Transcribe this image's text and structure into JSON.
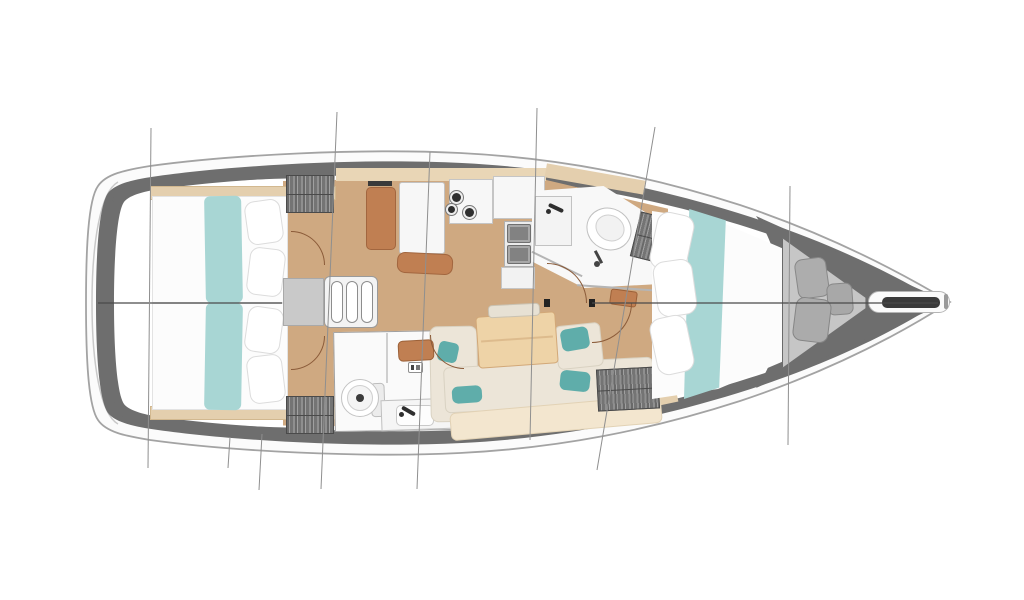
{
  "meta": {
    "drawing": "sailboat-interior-deck-plan",
    "canvas_width": 1024,
    "canvas_height": 600,
    "background": "#ffffff"
  },
  "palette": {
    "hull_fill": "#fbfbfb",
    "hull_stroke": "#a3a3a3",
    "deck_band": "#6e6e6e",
    "interior": "#ffffff",
    "floor_wood": "#cfa981",
    "wood_trim": "#e4cfae",
    "teal_fabric": "#a8d6d4",
    "teal_pillow": "#5fadaa",
    "sofa_cream": "#ece5d8",
    "sofa_back": "#f3e6cf",
    "furniture_brown": "#c07f52",
    "locker_gray": "#7c7c7c",
    "centerline": "#4a4a4a",
    "station_line": "#8f8f8f",
    "door_arc": "#8a5a38"
  },
  "hull": {
    "paths": [
      {
        "name": "hull-outer",
        "d": "M950,302 C900,272 830,235 740,205 C650,176 560,158 460,153 C360,148 230,155 150,166 C125,170 106,174 98,186 C88,200 86,250 86,303 C86,356 88,406 98,420 C106,432 125,436 150,440 C230,451 360,458 460,453 C560,448 650,430 740,401 C830,371 900,334 950,302 Z",
        "fill": "#fbfbfb",
        "stroke": "#a3a3a3",
        "sw": 1.8
      },
      {
        "name": "transom-inner-line",
        "d": "M118,182 C100,192 92,244 92,303 C92,362 100,414 118,424",
        "fill": "none",
        "stroke": "#c9c9c9",
        "sw": 1.5
      },
      {
        "name": "deck-band",
        "d": "M940,302 C895,275 828,241 738,213 C650,186 560,168 462,163 C364,158 236,165 158,176 C136,179 116,183 108,193 C99,206 96,252 96,303 C96,354 99,400 108,413 C116,423 136,427 158,430 C236,441 364,448 462,443 C560,438 650,420 738,393 C828,365 895,331 940,302 Z",
        "fill": "#6e6e6e",
        "stroke": "none",
        "sw": 0
      },
      {
        "name": "interior-fill",
        "d": "M922,302 C880,278 818,248 730,222 C646,197 558,180 462,176 C368,172 242,178 168,188 C150,190 130,194 124,202 C117,212 114,255 114,303 C114,351 117,394 124,404 C130,412 150,416 168,418 C242,428 368,434 462,430 C558,426 646,409 730,384 C818,358 880,328 922,302 Z",
        "fill": "#ffffff",
        "stroke": "none",
        "sw": 0
      },
      {
        "name": "stern-wedge-top",
        "d": "M112,200 C120,186 145,178 190,173 L330,166 L330,178 C260,178 190,182 150,190 C132,194 120,198 116,205 Z",
        "fill": "#6e6e6e",
        "stroke": "none",
        "sw": 0
      },
      {
        "name": "stern-wedge-bottom",
        "d": "M112,406 C120,420 145,428 190,433 L330,440 L330,428 C260,428 190,424 150,416 C132,412 120,408 116,401 Z",
        "fill": "#6e6e6e",
        "stroke": "none",
        "sw": 0
      },
      {
        "name": "bow-wedge",
        "d": "M756,216 L948,302 L756,388 C790,342 790,264 756,216 Z",
        "fill": "#6e6e6e",
        "stroke": "none",
        "sw": 0
      }
    ]
  },
  "furniture": [
    {
      "n": "salon-floor",
      "x": 283,
      "y": 176,
      "w": 385,
      "h": 252,
      "f": "#cfa981",
      "cls": "plank",
      "clip": "polygon(0 2%,64% 0,100% 13%,100% 79%,82% 97%,56% 100%,0 99%)"
    },
    {
      "n": "shelf-trim-aft-top",
      "x": 150,
      "y": 186,
      "w": 186,
      "h": 14,
      "f": "#e4cfae",
      "b": "#d2b88f"
    },
    {
      "n": "shelf-trim-aft-bottom",
      "x": 150,
      "y": 406,
      "w": 186,
      "h": 14,
      "f": "#e4cfae",
      "b": "#d2b88f"
    },
    {
      "n": "shelf-trim-galley-top",
      "x": 336,
      "y": 168,
      "w": 210,
      "h": 13,
      "f": "#e9d6b6"
    },
    {
      "n": "shelf-trim-fwd-top",
      "x": 545,
      "y": 172,
      "w": 100,
      "h": 14,
      "f": "#e4cfae",
      "rot": 10
    },
    {
      "n": "shelf-trim-fwd-bottom",
      "x": 578,
      "y": 398,
      "w": 100,
      "h": 14,
      "f": "#e4cfae",
      "rot": -12
    },
    {
      "n": "bed-aft-port",
      "x": 152,
      "y": 196,
      "w": 136,
      "h": 107,
      "f": "#fcfcfc",
      "b": "#e3e3e3"
    },
    {
      "n": "bed-runner-teal-port",
      "x": 205,
      "y": 196,
      "w": 37,
      "h": 107,
      "f": "#a8d6d4",
      "rad": "6px",
      "rot": -1
    },
    {
      "n": "pillow-aft-port-1",
      "x": 246,
      "y": 200,
      "w": 36,
      "h": 44,
      "f": "#ffffff",
      "b": "#dcdcdc",
      "rad": "10px",
      "rot": -8
    },
    {
      "n": "pillow-aft-port-2",
      "x": 248,
      "y": 248,
      "w": 36,
      "h": 48,
      "f": "#ffffff",
      "b": "#dcdcdc",
      "rad": "10px",
      "rot": 7
    },
    {
      "n": "bed-aft-starboard",
      "x": 152,
      "y": 303,
      "w": 136,
      "h": 107,
      "f": "#fcfcfc",
      "b": "#e3e3e3"
    },
    {
      "n": "bed-runner-teal-starboard",
      "x": 205,
      "y": 303,
      "w": 37,
      "h": 107,
      "f": "#a8d6d4",
      "rad": "6px",
      "rot": 1
    },
    {
      "n": "pillow-aft-starboard-1",
      "x": 246,
      "y": 307,
      "w": 36,
      "h": 46,
      "f": "#ffffff",
      "b": "#dcdcdc",
      "rad": "10px",
      "rot": 8
    },
    {
      "n": "pillow-aft-starboard-2",
      "x": 248,
      "y": 355,
      "w": 36,
      "h": 48,
      "f": "#ffffff",
      "b": "#dcdcdc",
      "rad": "10px",
      "rot": -7
    },
    {
      "n": "hanging-locker-aft-port",
      "x": 286,
      "y": 175,
      "w": 48,
      "h": 38,
      "cls": "hatch"
    },
    {
      "n": "hanging-locker-aft-starboard",
      "x": 286,
      "y": 396,
      "w": 48,
      "h": 38,
      "cls": "hatch"
    },
    {
      "n": "companionway-landing",
      "x": 283,
      "y": 278,
      "w": 41,
      "h": 48,
      "f": "#c9c9c9",
      "b": "#a9a9a9"
    },
    {
      "n": "companionway-steps-frame",
      "x": 324,
      "y": 276,
      "w": 54,
      "h": 52,
      "f": "#f3f3f3",
      "b": "#9a9a9a",
      "rad": "6px"
    },
    {
      "n": "companionway-step-1",
      "x": 331,
      "y": 281,
      "w": 12,
      "h": 42,
      "f": "#ffffff",
      "b": "#8d8d8d",
      "rad": "6px"
    },
    {
      "n": "companionway-step-2",
      "x": 346,
      "y": 281,
      "w": 12,
      "h": 42,
      "f": "#ffffff",
      "b": "#8d8d8d",
      "rad": "6px"
    },
    {
      "n": "companionway-step-3",
      "x": 361,
      "y": 281,
      "w": 12,
      "h": 42,
      "f": "#ffffff",
      "b": "#8d8d8d",
      "rad": "6px"
    },
    {
      "n": "nav-seat",
      "x": 366,
      "y": 187,
      "w": 30,
      "h": 63,
      "f": "#c07f52",
      "b": "#a2663f",
      "rad": "5px"
    },
    {
      "n": "nav-table",
      "x": 399,
      "y": 182,
      "w": 46,
      "h": 72,
      "f": "#f7f7f7",
      "b": "#c2c2c2",
      "rad": "3px"
    },
    {
      "n": "galley-vent-slot",
      "x": 368,
      "y": 181,
      "w": 24,
      "h": 5,
      "f": "#3a3a3a"
    },
    {
      "n": "nav-locker",
      "x": 397,
      "y": 253,
      "w": 56,
      "h": 21,
      "f": "#c07f52",
      "b": "#a2663f",
      "rad": "8px",
      "rot": 3
    },
    {
      "n": "galley-stove-counter",
      "x": 449,
      "y": 179,
      "w": 44,
      "h": 45,
      "f": "#f7f7f7",
      "b": "#c5c5c5"
    },
    {
      "n": "stove-burner-ring-1",
      "x": 449,
      "y": 190,
      "w": 15,
      "h": 15,
      "f": "#ededed",
      "b": "#777777",
      "rad": "50%"
    },
    {
      "n": "stove-burner-dot-1",
      "x": 452,
      "y": 193,
      "w": 9,
      "h": 9,
      "f": "#2f2f2f",
      "rad": "50%"
    },
    {
      "n": "stove-burner-ring-2",
      "x": 445,
      "y": 203,
      "w": 13,
      "h": 13,
      "f": "#ededed",
      "b": "#777777",
      "rad": "50%"
    },
    {
      "n": "stove-burner-dot-2",
      "x": 448,
      "y": 206,
      "w": 7,
      "h": 7,
      "f": "#2f2f2f",
      "rad": "50%"
    },
    {
      "n": "stove-burner-ring-3",
      "x": 462,
      "y": 205,
      "w": 15,
      "h": 15,
      "f": "#ededed",
      "b": "#777777",
      "rad": "50%"
    },
    {
      "n": "stove-burner-dot-3",
      "x": 465,
      "y": 208,
      "w": 9,
      "h": 9,
      "f": "#2f2f2f",
      "rad": "50%"
    },
    {
      "n": "galley-counter-right",
      "x": 493,
      "y": 176,
      "w": 52,
      "h": 43,
      "f": "#f7f7f7",
      "b": "#c5c5c5"
    },
    {
      "n": "galley-sink-unit",
      "x": 504,
      "y": 221,
      "w": 30,
      "h": 46,
      "f": "#ececec",
      "b": "#b0b0b0"
    },
    {
      "n": "galley-sink-basin-1",
      "x": 507,
      "y": 224,
      "w": 24,
      "h": 19,
      "f": "#a8a8a8",
      "b": "#6f6f6f",
      "rad": "2px"
    },
    {
      "n": "galley-sink-inner-1",
      "x": 510,
      "y": 227,
      "w": 18,
      "h": 13,
      "f": "#828282"
    },
    {
      "n": "galley-sink-basin-2",
      "x": 507,
      "y": 245,
      "w": 24,
      "h": 19,
      "f": "#a8a8a8",
      "b": "#6f6f6f",
      "rad": "2px"
    },
    {
      "n": "galley-sink-inner-2",
      "x": 510,
      "y": 248,
      "w": 18,
      "h": 13,
      "f": "#828282"
    },
    {
      "n": "galley-cabinet",
      "x": 501,
      "y": 267,
      "w": 34,
      "h": 22,
      "f": "#f2f2f2",
      "b": "#c5c5c5"
    },
    {
      "n": "aft-heads-room",
      "x": 334,
      "y": 331,
      "w": 121,
      "h": 100,
      "f": "#fafafa",
      "b": "#9f9f9f",
      "rot": -1
    },
    {
      "n": "aft-heads-wall",
      "x": 386,
      "y": 333,
      "w": 2,
      "h": 50,
      "f": "#cfcfcf"
    },
    {
      "n": "aft-toilet-tank",
      "x": 371,
      "y": 383,
      "w": 14,
      "h": 34,
      "f": "#ececec",
      "b": "#bdbdbd",
      "rad": "4px",
      "rot": -2
    },
    {
      "n": "aft-toilet-bowl",
      "x": 341,
      "y": 379,
      "w": 38,
      "h": 38,
      "f": "#ffffff",
      "b": "#c3c3c3",
      "rad": "50%"
    },
    {
      "n": "aft-toilet-seat",
      "x": 347,
      "y": 385,
      "w": 26,
      "h": 26,
      "f": "#f4f4f4",
      "b": "#cfcfcf",
      "rad": "50%"
    },
    {
      "n": "aft-toilet-drain",
      "x": 356,
      "y": 394,
      "w": 8,
      "h": 8,
      "f": "#3a3a3a",
      "rad": "50%"
    },
    {
      "n": "aft-heads-vanity",
      "x": 381,
      "y": 399,
      "w": 70,
      "h": 31,
      "f": "#f5f5f5",
      "b": "#c0c0c0",
      "rot": -2
    },
    {
      "n": "aft-heads-basin",
      "x": 396,
      "y": 405,
      "w": 38,
      "h": 21,
      "f": "#fdfdfd",
      "b": "#c9c9c9",
      "rad": "5px"
    },
    {
      "n": "aft-heads-faucet",
      "x": 401,
      "y": 409,
      "w": 15,
      "h": 4,
      "f": "#2e2e2e",
      "rad": "2px",
      "rot": 30
    },
    {
      "n": "aft-heads-faucet-dot",
      "x": 399,
      "y": 412,
      "w": 5,
      "h": 5,
      "f": "#2e2e2e",
      "rad": "50%"
    },
    {
      "n": "vent-icon",
      "x": 408,
      "y": 362,
      "w": 15,
      "h": 11,
      "f": "#ffffff",
      "b": "#8f8f8f",
      "rad": "2px"
    },
    {
      "n": "vent-icon-mark-a",
      "x": 411,
      "y": 365,
      "w": 3,
      "h": 5,
      "f": "#444444"
    },
    {
      "n": "vent-icon-mark-b",
      "x": 416,
      "y": 365,
      "w": 4,
      "h": 5,
      "f": "#777777"
    },
    {
      "n": "sofa-chaise",
      "x": 430,
      "y": 326,
      "w": 48,
      "h": 96,
      "f": "#ece5d8",
      "b": "#d9d2c2",
      "rad": "8px",
      "rot": -1
    },
    {
      "n": "sofa-seat-row",
      "x": 444,
      "y": 362,
      "w": 210,
      "h": 46,
      "f": "#ece5d8",
      "b": "#d9d2c2",
      "rad": "6px",
      "rot": -3,
      "cls": "cushions"
    },
    {
      "n": "sofa-back-row",
      "x": 450,
      "y": 404,
      "w": 212,
      "h": 28,
      "f": "#f3e6cf",
      "b": "#e2d2b5",
      "rad": "6px",
      "rot": -5,
      "cls": "cushions"
    },
    {
      "n": "sofa-seat-right",
      "x": 556,
      "y": 324,
      "w": 46,
      "h": 44,
      "f": "#ece5d8",
      "b": "#d9d2c2",
      "rad": "6px",
      "rot": -6
    },
    {
      "n": "pillow-teal-1",
      "x": 438,
      "y": 342,
      "w": 20,
      "h": 20,
      "f": "#5fadaa",
      "rad": "5px",
      "rot": 12
    },
    {
      "n": "pillow-teal-2",
      "x": 561,
      "y": 328,
      "w": 28,
      "h": 22,
      "f": "#5fadaa",
      "rad": "6px",
      "rot": -10
    },
    {
      "n": "pillow-teal-3",
      "x": 560,
      "y": 371,
      "w": 30,
      "h": 20,
      "f": "#5fadaa",
      "rad": "6px",
      "rot": 6
    },
    {
      "n": "pillow-teal-4",
      "x": 452,
      "y": 386,
      "w": 30,
      "h": 17,
      "f": "#5fadaa",
      "rad": "6px",
      "rot": -4
    },
    {
      "n": "salon-table",
      "x": 477,
      "y": 314,
      "w": 80,
      "h": 52,
      "f": "#eed3a7",
      "b": "#d2a878",
      "rad": "4px",
      "rot": -4
    },
    {
      "n": "salon-table-seam",
      "x": 481,
      "y": 338,
      "w": 72,
      "h": 2,
      "f": "#ddbb8d",
      "rot": -4
    },
    {
      "n": "salon-bench",
      "x": 488,
      "y": 304,
      "w": 52,
      "h": 13,
      "f": "#e7e1d4",
      "b": "#c9c2b2",
      "rad": "4px",
      "rot": -3
    },
    {
      "n": "stool-brown",
      "x": 398,
      "y": 340,
      "w": 36,
      "h": 21,
      "f": "#c07f52",
      "b": "#9c6138",
      "rad": "5px",
      "rot": -3
    },
    {
      "n": "shelf-brown-fwd",
      "x": 610,
      "y": 290,
      "w": 27,
      "h": 16,
      "f": "#c07f52",
      "b": "#9c6138",
      "rad": "3px",
      "rot": 8
    },
    {
      "n": "fwd-heads-room",
      "x": 532,
      "y": 186,
      "w": 130,
      "h": 102,
      "f": "#f8f8f8",
      "clip": "polygon(0 5%,55% 0,90% 28%,100% 62%,100% 96%,40% 100%,0 74%)"
    },
    {
      "n": "fwd-heads-wall-a",
      "x": 529,
      "y": 263,
      "w": 56,
      "h": 2,
      "f": "#b5b5b5",
      "rot": 26
    },
    {
      "n": "fwd-heads-wall-b",
      "x": 577,
      "y": 287,
      "w": 84,
      "h": 2,
      "f": "#b5b5b5",
      "rot": 4
    },
    {
      "n": "fwd-heads-vanity",
      "x": 535,
      "y": 196,
      "w": 37,
      "h": 50,
      "f": "#f3f3f3",
      "b": "#c2c2c2"
    },
    {
      "n": "fwd-heads-faucet",
      "x": 548,
      "y": 206,
      "w": 16,
      "h": 4,
      "f": "#2e2e2e",
      "rad": "2px",
      "rot": 25
    },
    {
      "n": "fwd-heads-faucet-dot",
      "x": 546,
      "y": 209,
      "w": 5,
      "h": 5,
      "f": "#2e2e2e",
      "rad": "50%"
    },
    {
      "n": "fwd-toilet-bowl",
      "x": 586,
      "y": 208,
      "w": 46,
      "h": 42,
      "f": "#ffffff",
      "b": "#c0c0c0",
      "rad": "50%",
      "rot": 28
    },
    {
      "n": "fwd-toilet-seat",
      "x": 595,
      "y": 215,
      "w": 30,
      "h": 26,
      "f": "#f2f2f2",
      "b": "#d0d0d0",
      "rad": "50%",
      "rot": 28
    },
    {
      "n": "shower-hose",
      "x": 597,
      "y": 250,
      "w": 3,
      "h": 14,
      "f": "#444444",
      "rot": -28
    },
    {
      "n": "shower-head-dot",
      "x": 594,
      "y": 261,
      "w": 6,
      "h": 6,
      "f": "#444444",
      "rad": "50%"
    },
    {
      "n": "hanging-locker-fwd-top",
      "x": 635,
      "y": 214,
      "w": 27,
      "h": 46,
      "cls": "hatch",
      "rot": 14
    },
    {
      "n": "hanging-locker-fwd-bottom",
      "x": 597,
      "y": 368,
      "w": 62,
      "h": 42,
      "cls": "hatch",
      "rot": -3
    },
    {
      "n": "vberth-bed",
      "x": 652,
      "y": 205,
      "w": 132,
      "h": 200,
      "f": "#fcfcfc",
      "clip": "polygon(0 3%,50% 8%,100% 22%,100% 78%,50% 92%,0 97%)"
    },
    {
      "n": "vberth-runner-teal",
      "x": 684,
      "y": 209,
      "w": 44,
      "h": 190,
      "f": "#a8d6d4",
      "clip": "polygon(12% 0,95% 6%,80% 94%,0 100%)"
    },
    {
      "n": "vberth-pillow-1",
      "x": 653,
      "y": 213,
      "w": 38,
      "h": 58,
      "f": "#ffffff",
      "b": "#dcdcdc",
      "rad": "12px",
      "rot": 12
    },
    {
      "n": "vberth-pillow-2",
      "x": 655,
      "y": 260,
      "w": 40,
      "h": 56,
      "f": "#ffffff",
      "b": "#dcdcdc",
      "rad": "12px",
      "rot": -8
    },
    {
      "n": "vberth-pillow-3",
      "x": 653,
      "y": 316,
      "w": 38,
      "h": 58,
      "f": "#ffffff",
      "b": "#dcdcdc",
      "rad": "12px",
      "rot": -12
    },
    {
      "n": "bow-locker-floor",
      "x": 782,
      "y": 238,
      "w": 86,
      "h": 130,
      "f": "#c6c6c6",
      "b": "#6a6a6a",
      "clip": "polygon(0 0,97% 46%,97% 54%,0 100%)"
    },
    {
      "n": "fender-1",
      "x": 796,
      "y": 258,
      "w": 32,
      "h": 40,
      "f": "#adadad",
      "b": "#888888",
      "rad": "8px",
      "rot": -8,
      "cls": "fender-tex"
    },
    {
      "n": "fender-2",
      "x": 827,
      "y": 283,
      "w": 26,
      "h": 32,
      "f": "#a8a8a8",
      "b": "#888888",
      "rad": "7px",
      "rot": -4,
      "cls": "fender-tex"
    },
    {
      "n": "fender-3",
      "x": 794,
      "y": 298,
      "w": 36,
      "h": 44,
      "f": "#ababab",
      "b": "#858585",
      "rad": "9px",
      "rot": 7,
      "cls": "fender-tex"
    },
    {
      "n": "bowsprit",
      "x": 868,
      "y": 291,
      "w": 82,
      "h": 22,
      "f": "#fbfbfb",
      "b": "#b5b5b5",
      "rad": "11px"
    },
    {
      "n": "anchor-roller",
      "x": 882,
      "y": 297,
      "w": 58,
      "h": 11,
      "f": "#3b3b3b",
      "rad": "5px"
    },
    {
      "n": "anchor-tip",
      "x": 944,
      "y": 294,
      "w": 4,
      "h": 15,
      "f": "#9a9a9a",
      "rad": "2px"
    },
    {
      "n": "door-stop-fwd-heads",
      "x": 544,
      "y": 299,
      "w": 6,
      "h": 8,
      "f": "#222222"
    },
    {
      "n": "door-stop-fwd-cabin",
      "x": 589,
      "y": 299,
      "w": 6,
      "h": 8,
      "f": "#222222"
    }
  ],
  "door_arcs": [
    {
      "n": "door-arc-aft-port-cabin",
      "x": 291,
      "y": 231,
      "s": 34,
      "c": "tr"
    },
    {
      "n": "door-arc-aft-starboard-cabin",
      "x": 291,
      "y": 336,
      "s": 34,
      "c": "br"
    },
    {
      "n": "door-arc-aft-heads",
      "x": 430,
      "y": 335,
      "s": 34,
      "c": "bl"
    },
    {
      "n": "door-arc-fwd-heads",
      "x": 547,
      "y": 263,
      "s": 40,
      "c": "tr"
    },
    {
      "n": "door-arc-fwd-cabin",
      "x": 592,
      "y": 303,
      "s": 40,
      "c": "br"
    }
  ],
  "lines": {
    "centerline": {
      "color": "#4a4a4a",
      "width": 1.2,
      "segments": [
        [
          98,
          303,
          282,
          303
        ],
        [
          592,
          303,
          938,
          303
        ]
      ]
    },
    "stations": {
      "color": "#8f8f8f",
      "width": 1,
      "segments": [
        [
          151,
          128,
          148,
          468
        ],
        [
          337,
          112,
          321,
          489
        ],
        [
          430,
          152,
          417,
          489
        ],
        [
          537,
          108,
          530,
          440
        ],
        [
          655,
          127,
          597,
          470
        ],
        [
          790,
          186,
          788,
          445
        ],
        [
          230,
          437,
          228,
          468
        ],
        [
          262,
          434,
          259,
          490
        ]
      ]
    }
  }
}
